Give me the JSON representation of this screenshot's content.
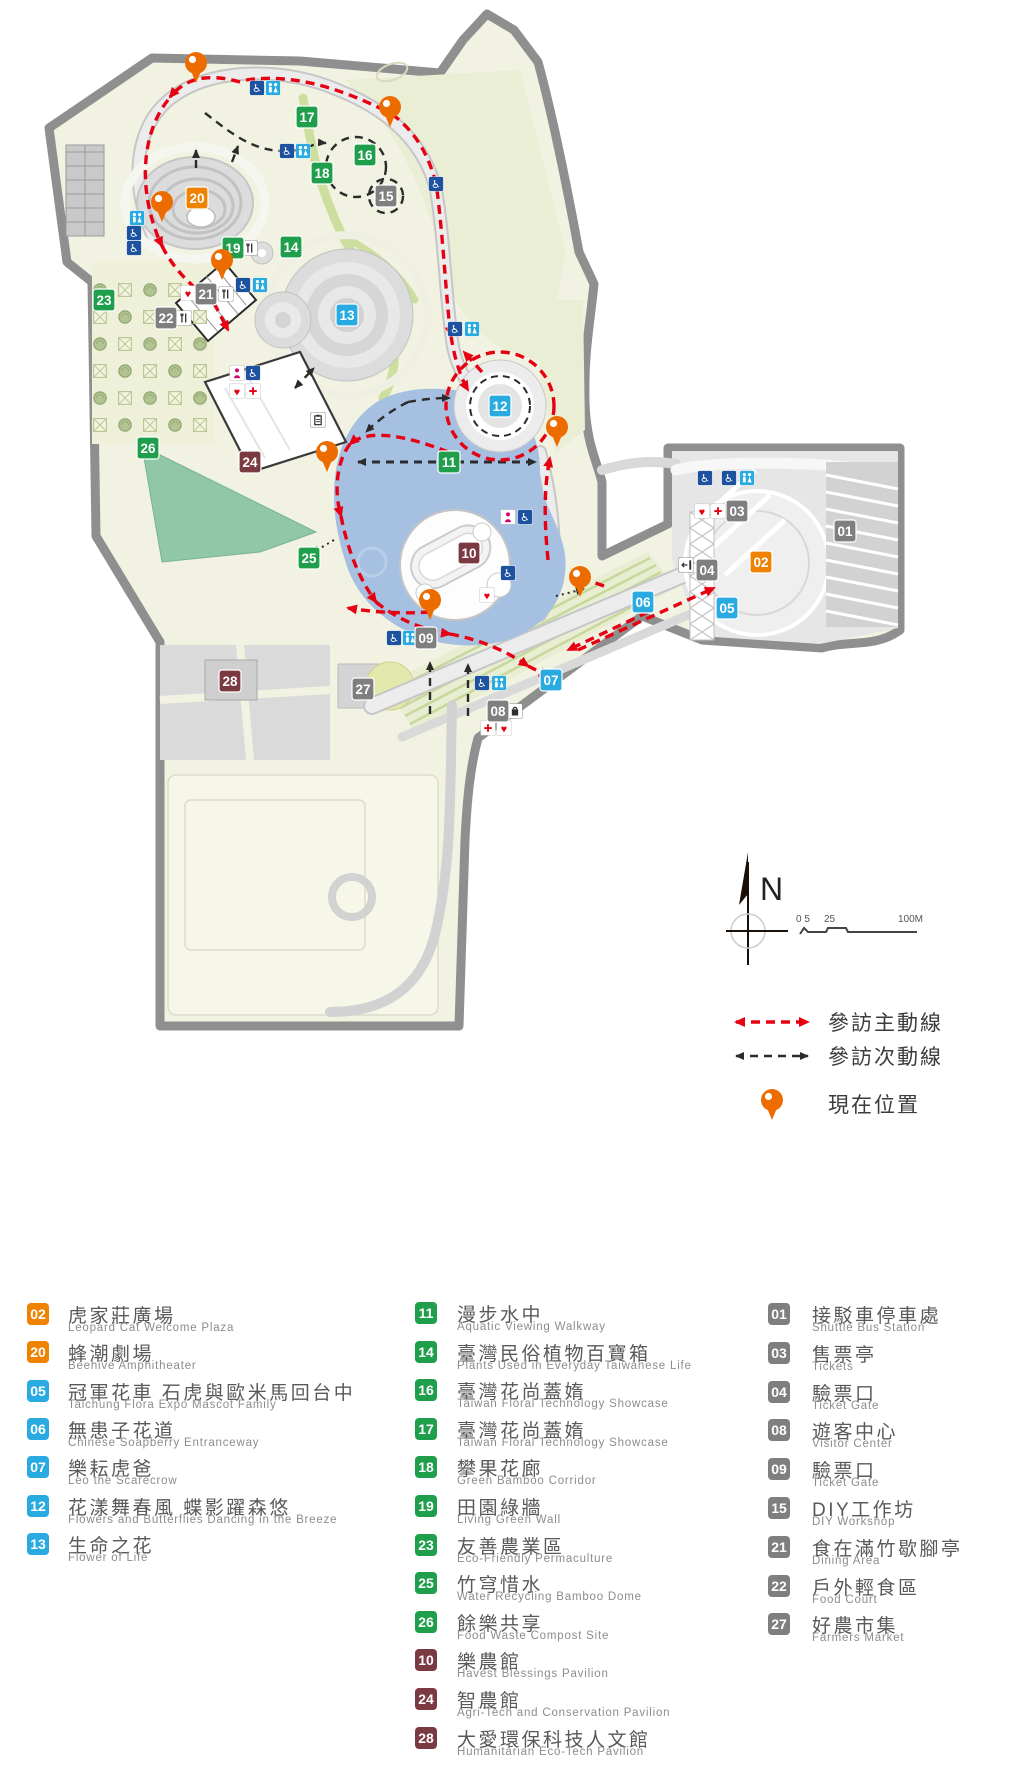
{
  "colors": {
    "orange": "#ef8200",
    "blue": "#29abe2",
    "green": "#1f9e4c",
    "maroon": "#7b3a42",
    "gray": "#7f7f7f",
    "route_main": "#e60012",
    "route_secondary": "#2b2b2b",
    "pin": "#ed6c00",
    "lake": "#a6c0e2",
    "lawn": "#8fc7a7",
    "park_fill": "#f2f2e2",
    "border": "#8f8f8f"
  },
  "map": {
    "north_label": "N",
    "scale": {
      "labels": [
        "0 5",
        "25",
        "100M"
      ]
    },
    "route_legend": [
      {
        "type": "main",
        "label": "參訪主動線"
      },
      {
        "type": "secondary",
        "label": "參訪次動線"
      },
      {
        "type": "location",
        "label": "現在位置"
      }
    ],
    "badges": [
      {
        "n": "17",
        "c": "green",
        "x": 307,
        "y": 117
      },
      {
        "n": "16",
        "c": "green",
        "x": 365,
        "y": 155
      },
      {
        "n": "18",
        "c": "green",
        "x": 322,
        "y": 173
      },
      {
        "n": "15",
        "c": "gray",
        "x": 386,
        "y": 196
      },
      {
        "n": "20",
        "c": "orange",
        "x": 197,
        "y": 198
      },
      {
        "n": "19",
        "c": "green",
        "x": 233,
        "y": 248
      },
      {
        "n": "14",
        "c": "green",
        "x": 291,
        "y": 247
      },
      {
        "n": "23",
        "c": "green",
        "x": 104,
        "y": 300
      },
      {
        "n": "21",
        "c": "gray",
        "x": 206,
        "y": 294
      },
      {
        "n": "22",
        "c": "gray",
        "x": 166,
        "y": 318
      },
      {
        "n": "13",
        "c": "blue",
        "x": 347,
        "y": 315
      },
      {
        "n": "24",
        "c": "maroon",
        "x": 250,
        "y": 462
      },
      {
        "n": "12",
        "c": "blue",
        "x": 500,
        "y": 406
      },
      {
        "n": "11",
        "c": "green",
        "x": 449,
        "y": 462
      },
      {
        "n": "26",
        "c": "green",
        "x": 148,
        "y": 448
      },
      {
        "n": "25",
        "c": "green",
        "x": 309,
        "y": 558
      },
      {
        "n": "10",
        "c": "maroon",
        "x": 469,
        "y": 553
      },
      {
        "n": "02",
        "c": "orange",
        "x": 761,
        "y": 562
      },
      {
        "n": "01",
        "c": "gray",
        "x": 845,
        "y": 531
      },
      {
        "n": "03",
        "c": "gray",
        "x": 737,
        "y": 511
      },
      {
        "n": "04",
        "c": "gray",
        "x": 707,
        "y": 570
      },
      {
        "n": "05",
        "c": "blue",
        "x": 727,
        "y": 608
      },
      {
        "n": "06",
        "c": "blue",
        "x": 643,
        "y": 602
      },
      {
        "n": "09",
        "c": "gray",
        "x": 426,
        "y": 638
      },
      {
        "n": "07",
        "c": "blue",
        "x": 551,
        "y": 680
      },
      {
        "n": "08",
        "c": "gray",
        "x": 498,
        "y": 711
      },
      {
        "n": "27",
        "c": "gray",
        "x": 363,
        "y": 689
      },
      {
        "n": "28",
        "c": "maroon",
        "x": 230,
        "y": 681
      }
    ],
    "pins": [
      {
        "x": 196,
        "y": 63
      },
      {
        "x": 390,
        "y": 107
      },
      {
        "x": 162,
        "y": 202
      },
      {
        "x": 222,
        "y": 260
      },
      {
        "x": 327,
        "y": 452
      },
      {
        "x": 557,
        "y": 427
      },
      {
        "x": 580,
        "y": 577
      },
      {
        "x": 430,
        "y": 600
      }
    ],
    "icons": [
      {
        "t": "wc",
        "x": 257,
        "y": 88
      },
      {
        "t": "rest",
        "x": 273,
        "y": 88
      },
      {
        "t": "wc",
        "x": 287,
        "y": 151
      },
      {
        "t": "rest",
        "x": 303,
        "y": 151
      },
      {
        "t": "wc",
        "x": 436,
        "y": 184
      },
      {
        "t": "rest",
        "x": 137,
        "y": 218
      },
      {
        "t": "wc",
        "x": 134,
        "y": 233
      },
      {
        "t": "wc",
        "x": 134,
        "y": 248
      },
      {
        "t": "heart",
        "x": 188,
        "y": 293
      },
      {
        "t": "food",
        "x": 226,
        "y": 294
      },
      {
        "t": "food",
        "x": 184,
        "y": 318
      },
      {
        "t": "food",
        "x": 250,
        "y": 248
      },
      {
        "t": "wc",
        "x": 243,
        "y": 285
      },
      {
        "t": "rest",
        "x": 260,
        "y": 285
      },
      {
        "t": "wc",
        "x": 455,
        "y": 329
      },
      {
        "t": "rest",
        "x": 472,
        "y": 329
      },
      {
        "t": "nurse",
        "x": 237,
        "y": 373
      },
      {
        "t": "wc",
        "x": 253,
        "y": 373
      },
      {
        "t": "heart",
        "x": 237,
        "y": 391
      },
      {
        "t": "cross",
        "x": 253,
        "y": 391
      },
      {
        "t": "clip",
        "x": 318,
        "y": 420
      },
      {
        "t": "nurse",
        "x": 508,
        "y": 517
      },
      {
        "t": "wc",
        "x": 525,
        "y": 517
      },
      {
        "t": "wc",
        "x": 508,
        "y": 573
      },
      {
        "t": "heart",
        "x": 487,
        "y": 595
      },
      {
        "t": "wc",
        "x": 394,
        "y": 638
      },
      {
        "t": "rest",
        "x": 410,
        "y": 638
      },
      {
        "t": "wc",
        "x": 482,
        "y": 683
      },
      {
        "t": "rest",
        "x": 499,
        "y": 683
      },
      {
        "t": "shop",
        "x": 515,
        "y": 711
      },
      {
        "t": "cross",
        "x": 488,
        "y": 728
      },
      {
        "t": "heart",
        "x": 504,
        "y": 728
      },
      {
        "t": "exit",
        "x": 686,
        "y": 565
      },
      {
        "t": "wc",
        "x": 705,
        "y": 478
      },
      {
        "t": "wc",
        "x": 729,
        "y": 478
      },
      {
        "t": "rest",
        "x": 747,
        "y": 478
      },
      {
        "t": "heart",
        "x": 702,
        "y": 511
      },
      {
        "t": "cross",
        "x": 718,
        "y": 511
      }
    ]
  },
  "legend": {
    "columns": [
      {
        "items": [
          {
            "num": "02",
            "c": "orange",
            "title": "虎家莊廣場",
            "sub": "Leopard Cat Welcome Plaza"
          },
          {
            "num": "20",
            "c": "orange",
            "title": "蜂潮劇場",
            "sub": "Beehive Amphitheater"
          },
          {
            "num": "05",
            "c": "blue",
            "title": "冠軍花車 石虎與歐米馬回台中",
            "sub": "Taichung Flora Expo Mascot Family"
          },
          {
            "num": "06",
            "c": "blue",
            "title": "無患子花道",
            "sub": "Chinese Soapberry Entranceway"
          },
          {
            "num": "07",
            "c": "blue",
            "title": "樂耘虎爸",
            "sub": "Leo the Scarecrow"
          },
          {
            "num": "12",
            "c": "blue",
            "title": "花漾舞春風 蝶影躍森悠",
            "sub": "Flowers and Butterflies Dancing in the Breeze"
          },
          {
            "num": "13",
            "c": "blue",
            "title": "生命之花",
            "sub": "Flower  of  Life"
          }
        ]
      },
      {
        "items": [
          {
            "num": "11",
            "c": "green",
            "title": "漫步水中",
            "sub": "Aquatic Viewing Walkway"
          },
          {
            "num": "14",
            "c": "green",
            "title": "臺灣民俗植物百寶箱",
            "sub": "Plants Used in Everyday Taiwanese Life"
          },
          {
            "num": "16",
            "c": "green",
            "title": "臺灣花尚蓋媠",
            "sub": "Taiwan Floral Technology Showcase"
          },
          {
            "num": "17",
            "c": "green",
            "title": "臺灣花尚蓋媠",
            "sub": "Taiwan Floral Technology Showcase"
          },
          {
            "num": "18",
            "c": "green",
            "title": "攀果花廊",
            "sub": "Green Bamboo Corridor"
          },
          {
            "num": "19",
            "c": "green",
            "title": "田園綠牆",
            "sub": "Living Green Wall"
          },
          {
            "num": "23",
            "c": "green",
            "title": "友善農業區",
            "sub": "Eco-Friendly Permaculture"
          },
          {
            "num": "25",
            "c": "green",
            "title": "竹穹惜水",
            "sub": "Water Recycling Bamboo Dome"
          },
          {
            "num": "26",
            "c": "green",
            "title": "餘樂共享",
            "sub": "Food Waste Compost Site"
          },
          {
            "num": "10",
            "c": "maroon",
            "title": "樂農館",
            "sub": "Havest Blessings Pavilion"
          },
          {
            "num": "24",
            "c": "maroon",
            "title": "智農館",
            "sub": "Agri-Tech and Conservation Pavilion"
          },
          {
            "num": "28",
            "c": "maroon",
            "title": "大愛環保科技人文館",
            "sub": "Humanitarian Eco-Tech Pavilion"
          }
        ]
      },
      {
        "items": [
          {
            "num": "01",
            "c": "gray",
            "title": "接駁車停車處",
            "sub": "Shuttle Bus Station"
          },
          {
            "num": "03",
            "c": "gray",
            "title": "售票亭",
            "sub": "Tickets"
          },
          {
            "num": "04",
            "c": "gray",
            "title": "驗票口",
            "sub": "Ticket Gate"
          },
          {
            "num": "08",
            "c": "gray",
            "title": "遊客中心",
            "sub": "Visitor Center"
          },
          {
            "num": "09",
            "c": "gray",
            "title": "驗票口",
            "sub": "Ticket Gate"
          },
          {
            "num": "15",
            "c": "gray",
            "title": "DIY工作坊",
            "sub": "DIY Workshop"
          },
          {
            "num": "21",
            "c": "gray",
            "title": "食在滿竹歇腳亭",
            "sub": "Dining Area"
          },
          {
            "num": "22",
            "c": "gray",
            "title": "戶外輕食區",
            "sub": "Food Court"
          },
          {
            "num": "27",
            "c": "gray",
            "title": "好農市集",
            "sub": "Farmers Market"
          }
        ]
      }
    ]
  }
}
